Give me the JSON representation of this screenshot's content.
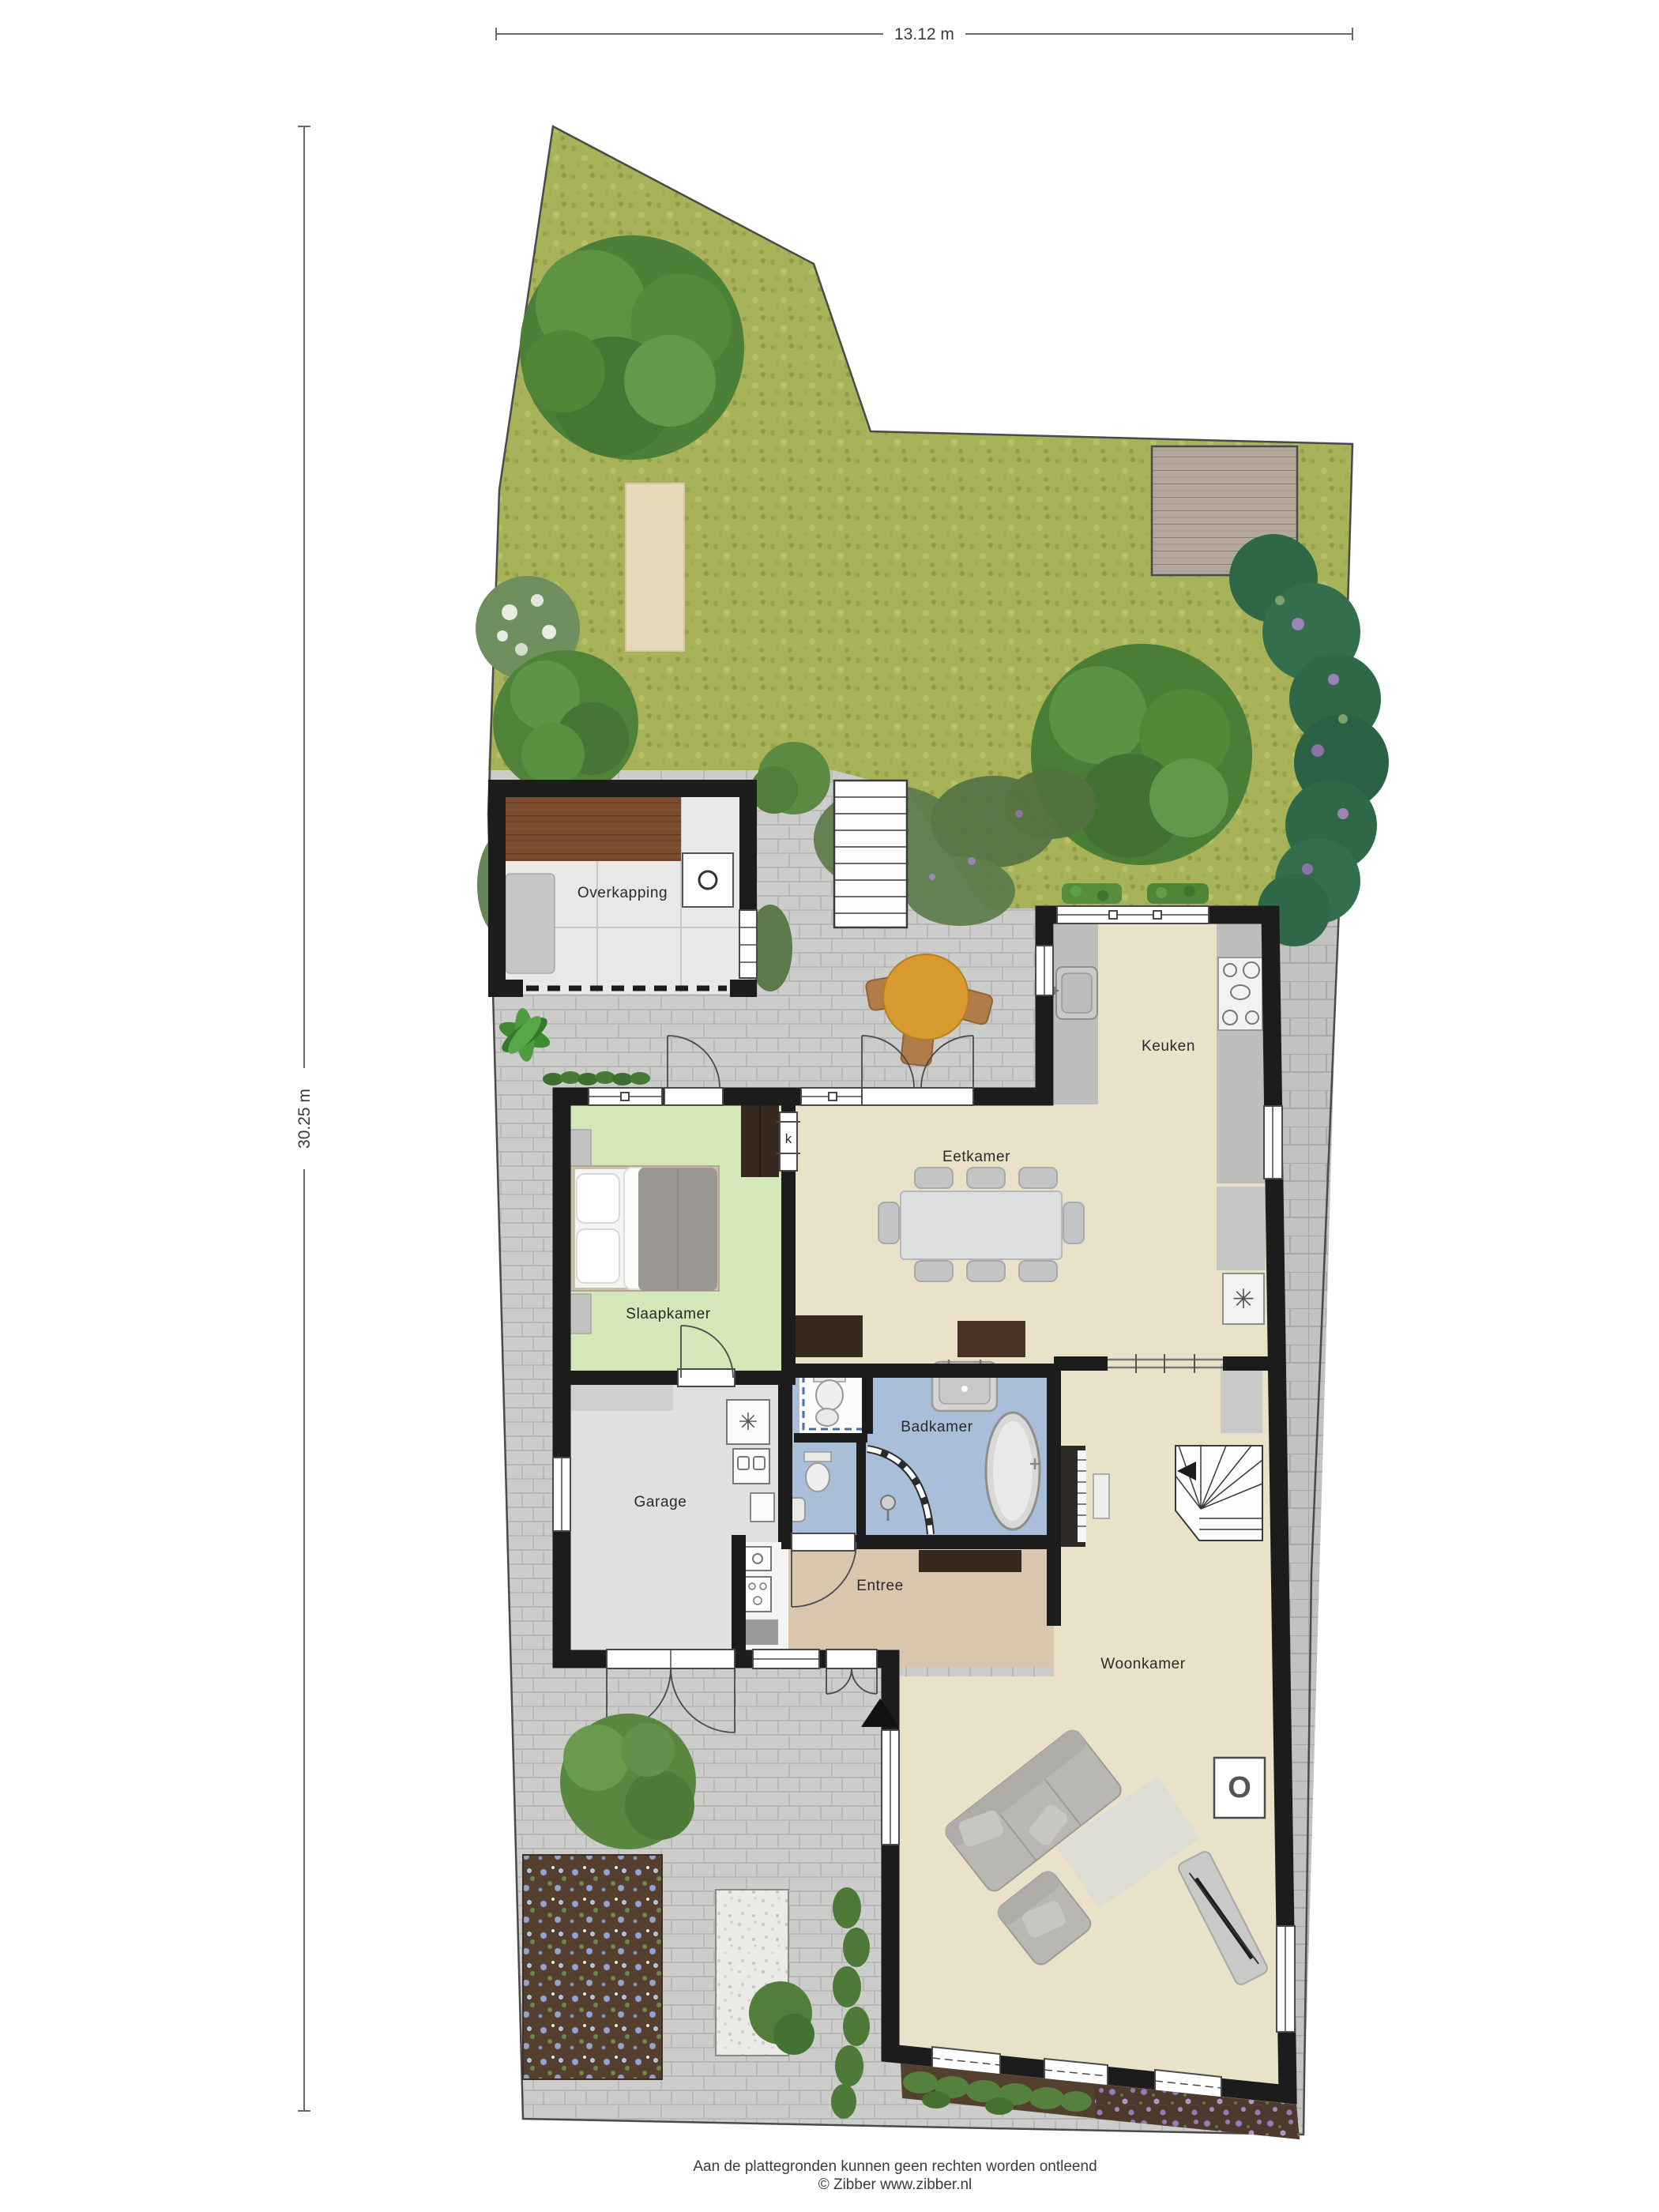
{
  "dimensions": {
    "width_label": "13.12 m",
    "height_label": "30.25 m"
  },
  "rooms": {
    "overkapping": {
      "label": "Overkapping"
    },
    "keuken": {
      "label": "Keuken"
    },
    "eetkamer": {
      "label": "Eetkamer"
    },
    "slaapkamer": {
      "label": "Slaapkamer"
    },
    "garage": {
      "label": "Garage"
    },
    "badkamer": {
      "label": "Badkamer"
    },
    "entree": {
      "label": "Entree"
    },
    "woonkamer": {
      "label": "Woonkamer"
    },
    "closet": {
      "label": "k"
    }
  },
  "icons": {
    "boiler_symbol": "✳",
    "fireplace_symbol": "O"
  },
  "footer": {
    "line1": "Aan de plattegronden kunnen geen rechten worden ontleend",
    "line2": "© Zibber www.zibber.nl"
  },
  "colors": {
    "wall": "#1c1c1c",
    "floor-beige": "#eae2c8",
    "floor-green": "#d3e7b9",
    "floor-blue": "#a9bed9",
    "floor-tan": "#d9c6ad",
    "floor-gray": "#e0e0de",
    "floor-white": "#f4f4f2",
    "floor-light": "#e8e8e6",
    "grass": "#a7b259",
    "hedge": "#2e6847",
    "terrace": "#cccccb",
    "wood": "#7c4c2f",
    "table-orange": "#d89a2e",
    "darkwood": "#36291f",
    "furniture": "#c6c6c4"
  }
}
